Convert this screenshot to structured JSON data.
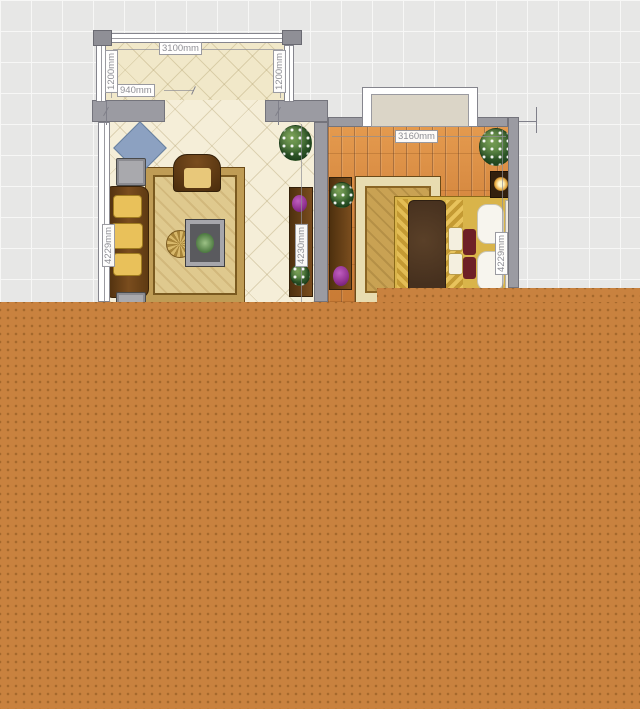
{
  "canvas": {
    "width_px": 640,
    "height_px": 709
  },
  "balcony": {
    "width_label": "3100mm",
    "left_depth_label": "1200mm",
    "right_depth_label": "1200mm",
    "opening_label": "940mm",
    "items": [
      "window-top",
      "window-left",
      "window-right"
    ]
  },
  "living_room": {
    "left_dim_label": "4229mm",
    "right_dim_label": "4230mm",
    "items": [
      "blue-diamond-rug",
      "sofa",
      "floor-cushions",
      "armchair",
      "area-rug",
      "coffee-table",
      "fan-ornament",
      "tv-cabinet",
      "purple-vase",
      "flowers",
      "potted-plant"
    ]
  },
  "bedroom": {
    "width_label": "3160mm",
    "right_dim_label": "4229mm",
    "items": [
      "window",
      "area-rug",
      "double-bed",
      "duvet",
      "pillows",
      "dresser",
      "purple-vase",
      "flowers",
      "nightstand-lamp",
      "potted-plant"
    ]
  },
  "overlay": {
    "description": "orange-dotted-region"
  },
  "colors": {
    "grid_bg": "#e7e7e6",
    "grid_line": "#f7f7f6",
    "wall": "#9b9ba2",
    "balcony_floor": "#f1e8c9",
    "living_floor": "#f5eed8",
    "wood_floor": "#d6893f",
    "overlay_orange": "#c9823f",
    "overlay_dot": "#a4682c",
    "label_text": "#8f8f95",
    "label_border": "#9a9aa0",
    "rug_gold": "#dfc98e",
    "duvet_brown": "#46301e",
    "accent_purple": "#8e2f8e",
    "pillow_yellow": "#e9c15a",
    "diamond_blue": "#8ca1c1"
  }
}
